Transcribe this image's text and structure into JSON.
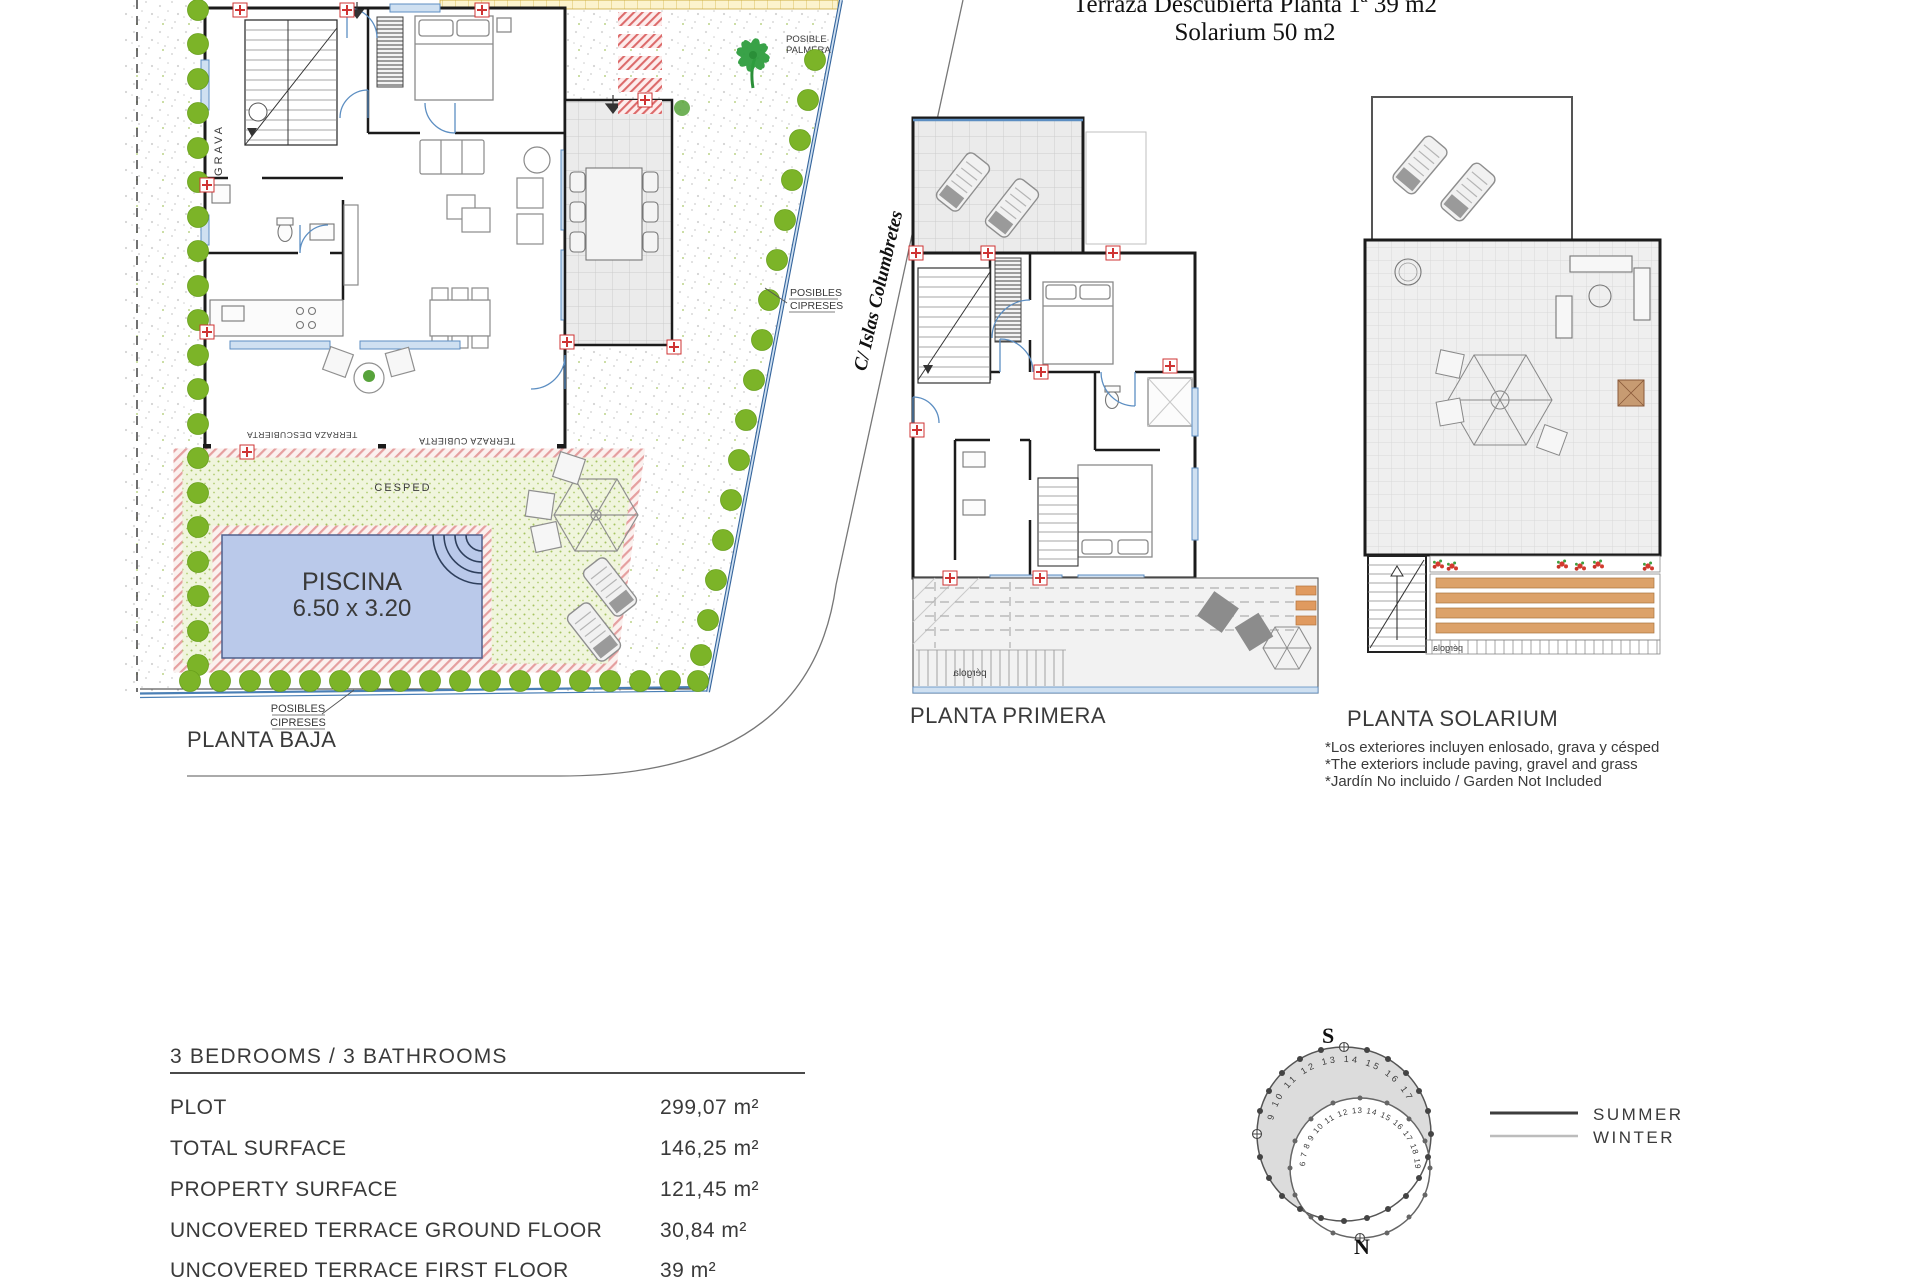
{
  "header": {
    "line1": "Terraza Descubierta Planta 1ª  39 m2",
    "line2": "Solarium  50 m2"
  },
  "street": {
    "name": "C/ Islas Columbretes"
  },
  "plans": {
    "baja": {
      "label": "PLANTA BAJA",
      "grava": "GRAVA",
      "cesped": "CESPED",
      "piscina": "PISCINA",
      "piscina_size": "6.50 x 3.20",
      "palmera_line1": "POSIBLE",
      "palmera_line2": "PALMERA",
      "cipreses_line1": "POSIBLES",
      "cipreses_line2": "CIPRESES",
      "terraza_descubierta": "TERRAZA DESCUBIERTA",
      "terraza_cubierta": "TERRAZA CUBIERTA"
    },
    "primera": {
      "label": "PLANTA PRIMERA",
      "pergola": "pérgola"
    },
    "solarium": {
      "label": "PLANTA SOLARIUM",
      "pergola": "pérgola",
      "notes": [
        "*Los exteriores incluyen enlosado, grava y césped",
        "*The exteriors include paving, gravel and grass",
        "*Jardín No incluido / Garden Not Included"
      ]
    }
  },
  "specs": {
    "title": "3 BEDROOMS / 3 BATHROOMS",
    "rows": [
      {
        "label": "PLOT",
        "value": "299,07 m²"
      },
      {
        "label": "TOTAL SURFACE",
        "value": "146,25 m²"
      },
      {
        "label": "PROPERTY SURFACE",
        "value": "121,45 m²"
      },
      {
        "label": "UNCOVERED TERRACE GROUND FLOOR",
        "value": "30,84 m²"
      },
      {
        "label": "UNCOVERED TERRACE FIRST FLOOR",
        "value": "39 m²"
      }
    ]
  },
  "sun": {
    "south": "S",
    "north": "N",
    "outer_hours": "9 10 11 12 13 14 15 16 17",
    "inner_hours": "6 7 8 9 10 11 12 13 14 15 16 17 18 19 20",
    "legend_summer": "SUMMER",
    "legend_winter": "WINTER"
  },
  "colors": {
    "tree_green": "#7cb428",
    "palm_green": "#2f9e3f",
    "pool_blue": "#bac9ea",
    "lawn": "#f0f5dd",
    "hatch_pink": "#e59f9f",
    "marker_red": "#cf3333",
    "window_blue": "#5c8ec2",
    "slat_orange": "#dca26a",
    "tile_gray": "#ececeb",
    "text_dark": "#3a3a3a"
  }
}
